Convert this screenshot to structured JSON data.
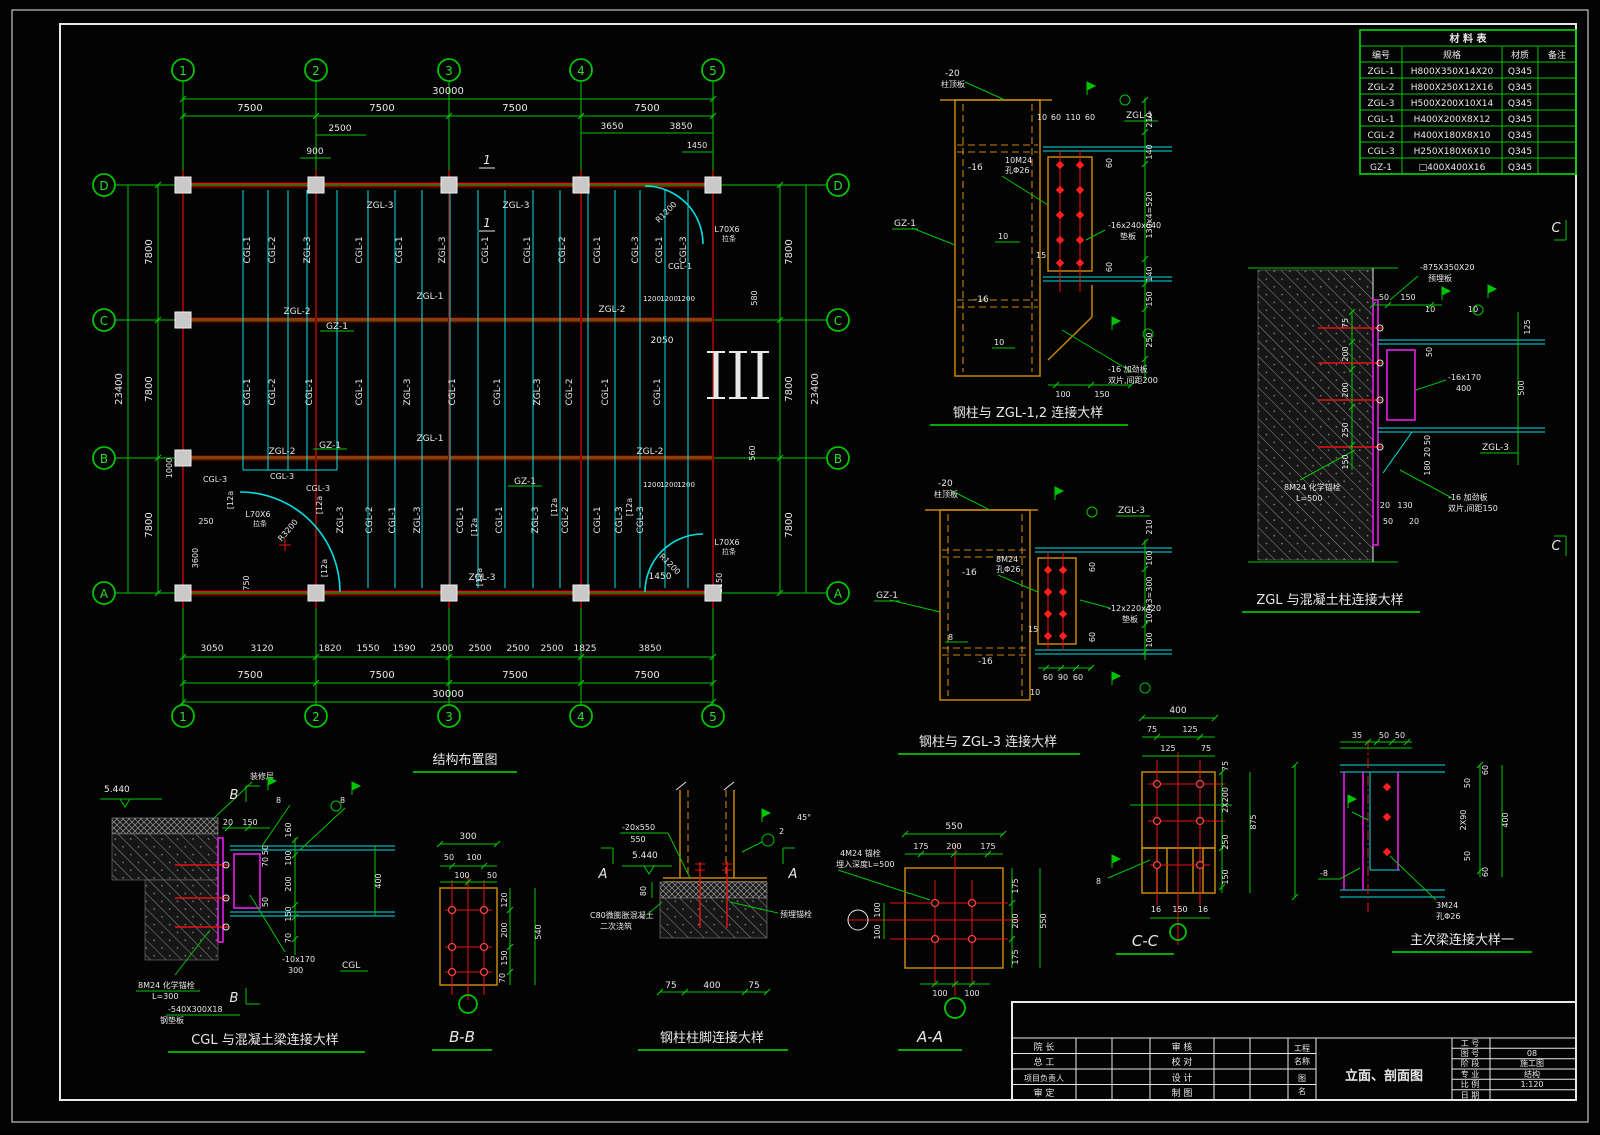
{
  "plan": {
    "title": "结构布置图",
    "grid_cols": [
      "1",
      "2",
      "3",
      "4",
      "5"
    ],
    "grid_rows": [
      "D",
      "C",
      "B",
      "A"
    ],
    "d30000": "30000",
    "d7500": "7500",
    "d23400": "23400",
    "d7800": "7800",
    "d2500": "2500",
    "d900": "900",
    "d3650": "3650",
    "d3850": "3850",
    "d1450": "1450",
    "b3050": "3050",
    "b3120": "3120",
    "b1820": "1820",
    "b1550": "1550",
    "b1590": "1590",
    "b2500": "2500",
    "b1825": "1825",
    "d1000": "1000",
    "d250": "250",
    "d3600": "3600",
    "d750": "750",
    "d2050": "2050",
    "d580": "580",
    "d560": "560",
    "d1150": "1150",
    "d1200": "1200",
    "channel": "[12a",
    "angle": "L70X6",
    "angle_sub": "拉条",
    "r3200": "R3200",
    "r1200": "R1200",
    "sec1": "1",
    "v_top": [
      "CGL-1",
      "CGL-2",
      "ZGL-3",
      "CGL-1",
      "CGL-1",
      "ZGL-3",
      "CGL-1",
      "CGL-1",
      "CGL-2",
      "CGL-1",
      "CGL-3",
      "CGL-1",
      "CGL-3"
    ],
    "v_mid": [
      "CGL-1",
      "CGL-2",
      "CGL-1",
      "CGL-1",
      "ZGL-3",
      "CGL-1",
      "CGL-1",
      "ZGL-3",
      "CGL-2",
      "CGL-1",
      "CGL-1"
    ],
    "v_bot": [
      "ZGL-3",
      "CGL-2",
      "CGL-1",
      "ZGL-3",
      "CGL-1",
      "CGL-1",
      "ZGL-3",
      "CGL-2",
      "CGL-1",
      "CGL-3",
      "CGL-3"
    ],
    "h_lbls": [
      "ZGL-3",
      "ZGL-3",
      "ZGL-1",
      "ZGL-2",
      "ZGL-2",
      "GZ-1",
      "ZGL-1",
      "ZGL-2",
      "ZGL-2",
      "GZ-1",
      "GZ-1",
      "ZGL-3",
      "CGL-3",
      "CGL-3",
      "CGL-3",
      "CGL-1"
    ]
  },
  "details": {
    "d1": {
      "title": "钢柱与 ZGL-1,2 连接大样",
      "plate": "-20",
      "plate2": "柱顶板",
      "gz": "GZ-1",
      "zgl": "ZGL-1",
      "t16": "-16",
      "bolts": "10M24",
      "holes": "孔Φ26",
      "d10": "10",
      "t15": "15",
      "pad": "-16x240x640",
      "pad2": "垫板",
      "stiff": "-16 加劲板",
      "stiff2": "双片,间距200",
      "d60": "60",
      "d110": "110",
      "r210": "210",
      "r140": "140",
      "r520": "130x4=520",
      "r150": "150",
      "r250": "250",
      "b100": "100",
      "b150": "150"
    },
    "d2": {
      "title": "钢柱与 ZGL-3 连接大样",
      "plate": "-20",
      "plate2": "柱顶板",
      "gz": "GZ-1",
      "zgl": "ZGL-3",
      "t16": "-16",
      "bolts": "8M24",
      "holes": "孔Φ26",
      "w8": "8",
      "t15": "15",
      "d10": "10",
      "pad": "-12x220x420",
      "pad2": "垫板",
      "r210": "210",
      "r100": "100",
      "r300": "100x3=300",
      "d60": "60",
      "d90": "90"
    },
    "d3": {
      "title": "ZGL 与混凝土柱连接大样",
      "embed": "-875X350X20",
      "embed2": "预埋板",
      "w10": "10",
      "plate": "-16x170",
      "plate2": "400",
      "zgl": "ZGL-3",
      "anchor": "8M24 化学锚栓",
      "anchor2": "L=500",
      "stiff": "-16 加劲板",
      "stiff2": "双片,间距150",
      "mark": "C",
      "d50": "50",
      "d150": "150",
      "d75": "75",
      "d200": "200",
      "d250": "250",
      "d125": "125",
      "d500": "500",
      "d20": "20",
      "d130": "130",
      "d180": "180"
    },
    "d4": {
      "title": "CGL 与混凝土梁连接大样",
      "elev": "5.440",
      "finish": "装修层",
      "mark": "B",
      "w8": "8",
      "plate": "-10x170",
      "plate2": "300",
      "cgl": "CGL",
      "anchor": "8M24 化学锚栓",
      "anchor2": "L=300",
      "pad": "-540X300X18",
      "pad2": "钢垫板",
      "d20": "20",
      "d150": "150",
      "d160": "160",
      "d50": "50",
      "d70": "70",
      "d100": "100",
      "d200": "200",
      "d400": "400"
    },
    "d5": {
      "title": "B-B",
      "d300": "300",
      "d50": "50",
      "d100": "100",
      "d120": "120",
      "d200": "200",
      "d150": "150",
      "d70": "70",
      "d540": "540"
    },
    "d6": {
      "title": "钢柱柱脚连接大样",
      "plate": "-20x550",
      "plate2": "550",
      "elev": "5.440",
      "d80": "80",
      "grout": "C80微膨胀混凝土",
      "grout2": "二次浇筑",
      "anchor": "预埋锚栓",
      "deg": "45°",
      "w2": "2",
      "mark": "A",
      "d75": "75",
      "d400": "400"
    },
    "d7": {
      "title": "A-A",
      "anchor": "4M24 锚栓",
      "anchor2": "埋入深度L=500",
      "d550": "550",
      "d175": "175",
      "d200": "200",
      "d100": "100"
    },
    "d8": {
      "title": "C-C",
      "w8": "8",
      "d400": "400",
      "d75": "75",
      "d125": "125",
      "d2x200": "2X200",
      "d250": "250",
      "d150": "150",
      "d875": "875",
      "d16": "16"
    },
    "d9": {
      "title": "主次梁连接大样一",
      "t8": "-8",
      "bolts": "3M24",
      "holes": "孔Φ26",
      "d35": "35",
      "d50": "50",
      "d60": "60",
      "d2x90": "2X90",
      "d400": "400"
    }
  },
  "material_table": {
    "title": "材  料  表",
    "headers": [
      "编号",
      "规格",
      "材质",
      "备注"
    ],
    "rows": [
      [
        "ZGL-1",
        "H800X350X14X20",
        "Q345",
        ""
      ],
      [
        "ZGL-2",
        "H800X250X12X16",
        "Q345",
        ""
      ],
      [
        "ZGL-3",
        "H500X200X10X14",
        "Q345",
        ""
      ],
      [
        "CGL-1",
        "H400X200X8X12",
        "Q345",
        ""
      ],
      [
        "CGL-2",
        "H400X180X8X10",
        "Q345",
        ""
      ],
      [
        "CGL-3",
        "H250X180X6X10",
        "Q345",
        ""
      ],
      [
        "GZ-1",
        "□400X400X16",
        "Q345",
        ""
      ]
    ]
  },
  "title_block": {
    "col1": [
      "院  长",
      "总  工",
      "项目负责人",
      "审  定"
    ],
    "col2": [
      "审  核",
      "校  对",
      "设  计",
      "制  图"
    ],
    "project_label1": "工程",
    "project_label2": "名称",
    "name_label1": "图",
    "name_label2": "名",
    "drawing_name": "立面、剖面图",
    "right_labels": [
      "工 号",
      "图 号",
      "阶 段",
      "专 业",
      "比 例",
      "日 期"
    ],
    "right_values": [
      "",
      "08",
      "施工图",
      "结构",
      "1:120",
      ""
    ]
  }
}
